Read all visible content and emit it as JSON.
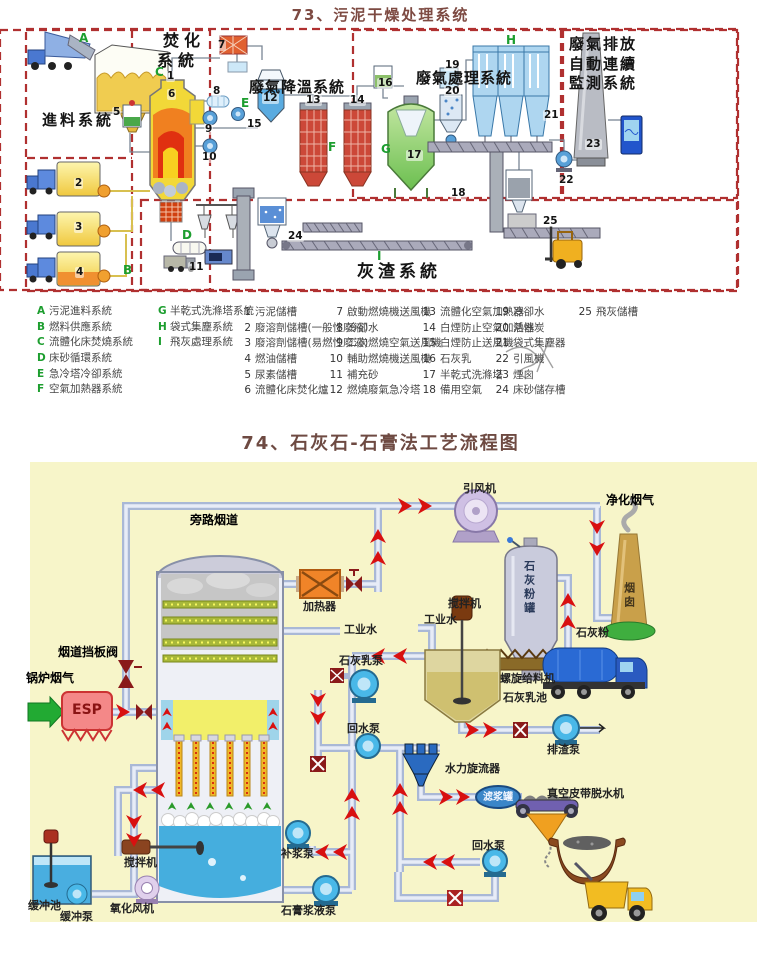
{
  "titles": {
    "t1": "73、污泥干燥处理系统",
    "t2": "74、石灰石-石膏法工艺流程图"
  },
  "d1": {
    "regions": {
      "feed": "進料系統",
      "incin1": "焚化",
      "incin2": "系統",
      "cool": "廢氣降溫系統",
      "treat": "廢氣處理系統",
      "mon1": "廢氣排放",
      "mon2": "自動連續",
      "mon3": "監測系統",
      "ash": "灰渣系統"
    },
    "letters": [
      "A",
      "B",
      "C",
      "D",
      "E",
      "F",
      "G",
      "H",
      "I"
    ],
    "numbers": [
      "1",
      "2",
      "3",
      "4",
      "5",
      "6",
      "7",
      "8",
      "9",
      "10",
      "11",
      "12",
      "13",
      "14",
      "15",
      "16",
      "17",
      "18",
      "19",
      "20",
      "21",
      "22",
      "23",
      "24",
      "25"
    ],
    "sys": [
      {
        "k": "A",
        "t": "污泥進料系統"
      },
      {
        "k": "B",
        "t": "燃料供應系統"
      },
      {
        "k": "C",
        "t": "流體化床焚燒系統"
      },
      {
        "k": "D",
        "t": "床砂循環系統"
      },
      {
        "k": "E",
        "t": "急冷塔冷卻系統"
      },
      {
        "k": "F",
        "t": "空氣加熱器系統"
      },
      {
        "k": "G",
        "t": "半乾式洗滌塔系統"
      },
      {
        "k": "H",
        "t": "袋式集塵系統"
      },
      {
        "k": "I",
        "t": "飛灰處理系統"
      }
    ],
    "itm": [
      {
        "k": "1",
        "t": "污泥儲槽"
      },
      {
        "k": "2",
        "t": "廢溶劑儲槽(一般性廢液)"
      },
      {
        "k": "3",
        "t": "廢溶劑儲槽(易燃性廢液)"
      },
      {
        "k": "4",
        "t": "燃油儲槽"
      },
      {
        "k": "5",
        "t": "尿素儲槽"
      },
      {
        "k": "6",
        "t": "流體化床焚化爐"
      },
      {
        "k": "7",
        "t": "啟動燃燒機送風機"
      },
      {
        "k": "8",
        "t": "冷卻水"
      },
      {
        "k": "9",
        "t": "二次燃燒空氣送風機"
      },
      {
        "k": "10",
        "t": "輔助燃燒機送風機"
      },
      {
        "k": "11",
        "t": "補充砂"
      },
      {
        "k": "12",
        "t": "燃燒廢氣急冷塔"
      },
      {
        "k": "13",
        "t": "流體化空氣加熱器"
      },
      {
        "k": "14",
        "t": "白煙防止空氣加熱器"
      },
      {
        "k": "15",
        "t": "白煙防止送風機"
      },
      {
        "k": "16",
        "t": "石灰乳"
      },
      {
        "k": "17",
        "t": "半乾式洗滌塔"
      },
      {
        "k": "18",
        "t": "備用空氣"
      },
      {
        "k": "19",
        "t": "冷卻水"
      },
      {
        "k": "20",
        "t": "活性炭"
      },
      {
        "k": "21",
        "t": "袋式集塵器"
      },
      {
        "k": "22",
        "t": "引風機"
      },
      {
        "k": "23",
        "t": "煙囪"
      },
      {
        "k": "24",
        "t": "床砂儲存槽"
      },
      {
        "k": "25",
        "t": "飛灰儲槽"
      }
    ]
  },
  "d2": {
    "labels": {
      "bypass": "旁路烟道",
      "idfan": "引风机",
      "clean": "净化烟气",
      "damper": "烟道挡板阀",
      "boiler": "锅炉烟气",
      "esp": "ESP",
      "heater": "加热器",
      "water1": "工业水",
      "water2": "工业水",
      "mixer1": "搅拌机",
      "silo": "石灰粉罐",
      "screw": "螺旋给料机",
      "limepool": "石灰乳池",
      "limepowder": "石灰粉",
      "limepump": "石灰乳泵",
      "chimney": "烟囱",
      "slagpump": "排渣泵",
      "cyclone": "水力旋流器",
      "filtertank": "滤浆罐",
      "vbelt": "真空皮带脱水机",
      "returnpump1": "回水泵",
      "returnpump2": "回水泵",
      "makeuppump": "补浆泵",
      "gypsumpump": "石膏浆液泵",
      "oxfan": "氧化风机",
      "mixer2": "搅拌机",
      "bufferpool": "缓冲池",
      "bufferpump": "缓冲泵"
    }
  }
}
